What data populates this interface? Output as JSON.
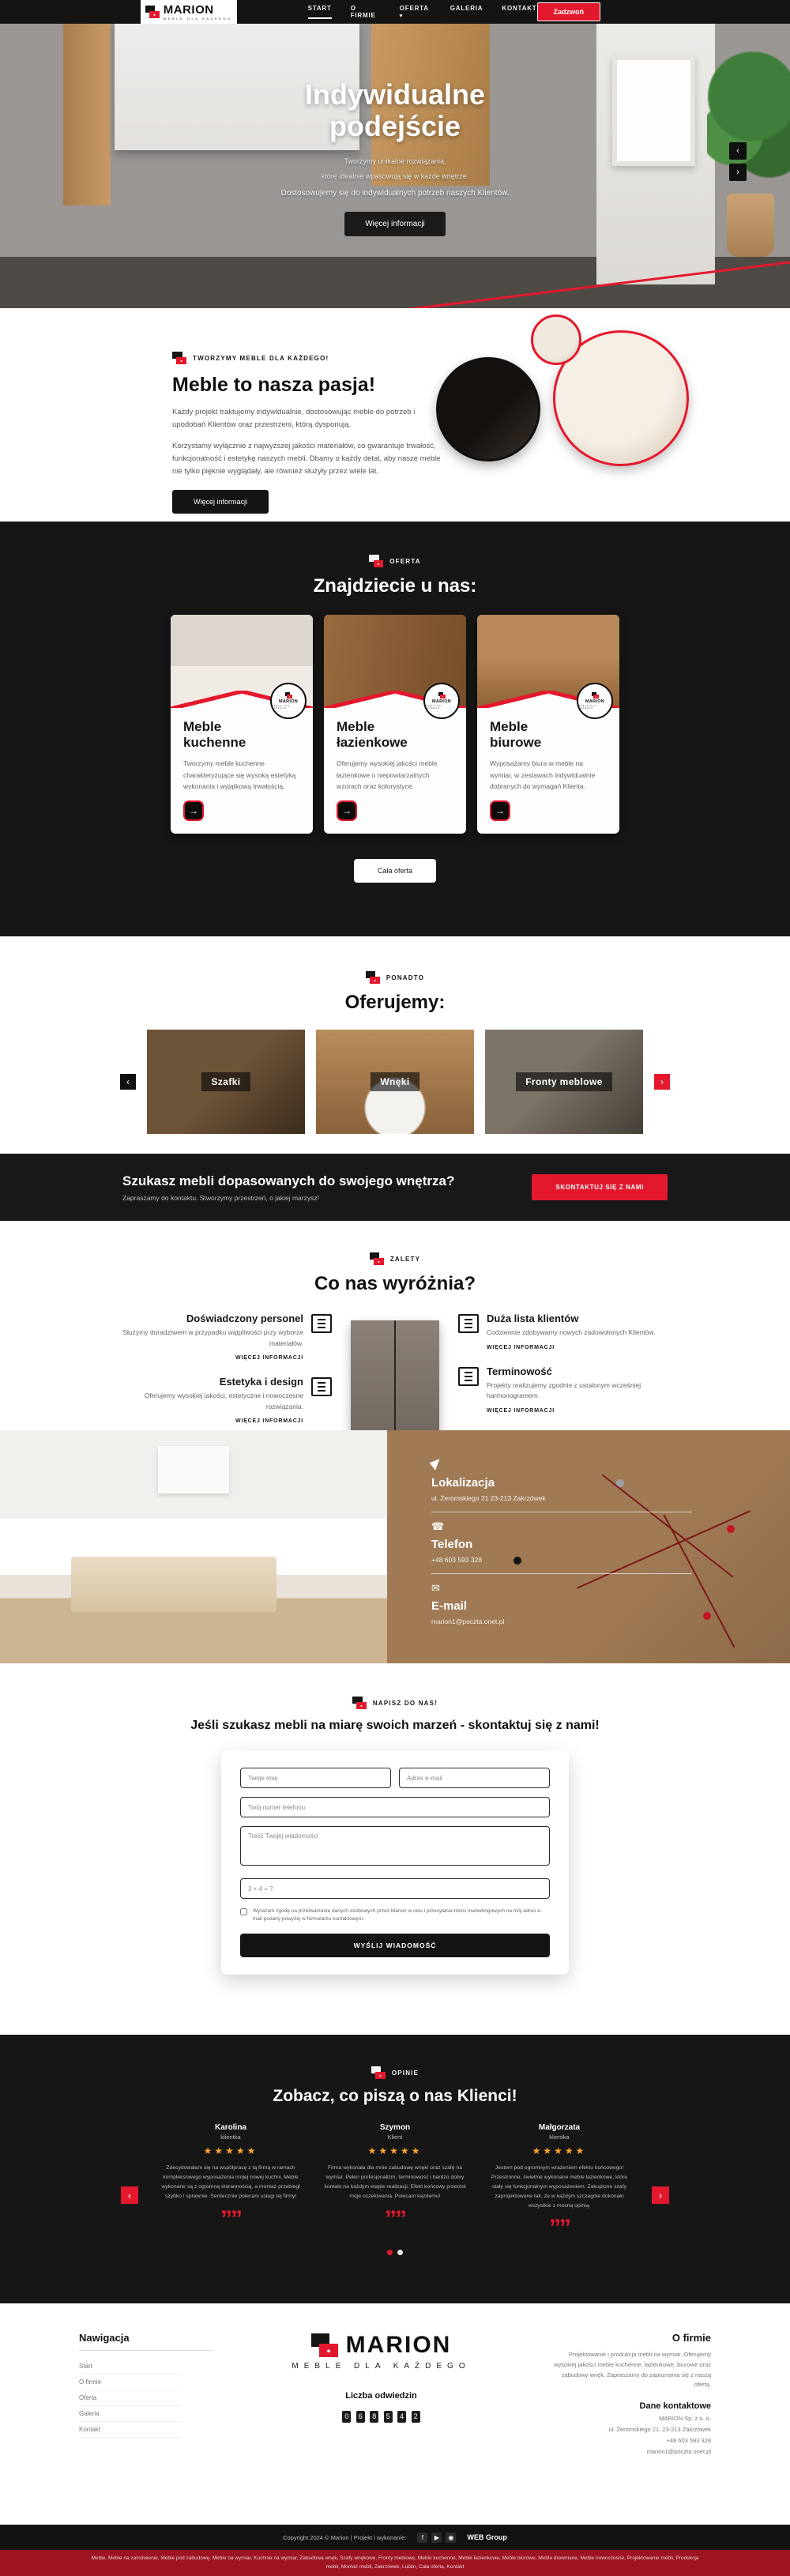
{
  "colors": {
    "accent": "#e4182d",
    "dark": "#161616",
    "star": "#ffa528",
    "cork": "#a07a55"
  },
  "header": {
    "logo_name": "MARION",
    "logo_tagline": "MEBLE DLA KAŻDEGO",
    "nav": [
      {
        "label": "START"
      },
      {
        "label": "O FIRMIE"
      },
      {
        "label": "OFERTA"
      },
      {
        "label": "GALERIA"
      },
      {
        "label": "KONTAKT"
      }
    ],
    "caret": "▾",
    "call_button": "Zadzwoń"
  },
  "hero": {
    "title_line1": "Indywidualne",
    "title_line2": "podejście",
    "subtitle_line1": "Tworzymy unikalne rozwiązania,",
    "subtitle_line2": "które idealnie wpasowują się w każde wnętrze.",
    "subtitle_line3": "Dostosowujemy się do indywidualnych potrzeb naszych Klientów.",
    "button": "Więcej informacji",
    "arrow_up": "‹",
    "arrow_down": "›"
  },
  "about": {
    "eyebrow": "TWORZYMY MEBLE DLA KAŻDEGO!",
    "title": "Meble to nasza pasja!",
    "p1": "Każdy projekt traktujemy indywidualnie, dostosowując meble do potrzeb i upodobań Klientów oraz przestrzeni, którą dysponują.",
    "p2": "Korzystamy wyłącznie z najwyższej jakości materiałów, co gwarantuje trwałość, funkcjonalność i estetykę naszych mebli. Dbamy o każdy detal, aby nasze meble nie tylko pięknie wyglądały, ale również służyły przez wiele lat.",
    "button": "Więcej informacji"
  },
  "offer": {
    "eyebrow": "OFERTA",
    "title": "Znajdziecie u nas:",
    "badge_name": "MARION",
    "badge_tag": "MEBLE DLA KAŻDEGO",
    "arrow": "→",
    "cards": [
      {
        "title": "Meble kuchenne",
        "text": "Tworzymy meble kuchenne charakteryzujące się wysoką estetyką wykonania i wyjątkową trwałością."
      },
      {
        "title": "Meble łazienkowe",
        "text": "Oferujemy wysokiej jakości meble łazienkowe o niepowtarzalnych wzorach oraz kolorystyce."
      },
      {
        "title": "Meble biurowe",
        "text": "Wyposażamy biura w meble na wymiar, w zestawach indywidualnie dobranych do wymagań Klienta."
      }
    ],
    "button": "Cała oferta"
  },
  "more": {
    "eyebrow": "PONADTO",
    "title": "Oferujemy:",
    "prev": "‹",
    "next": "›",
    "slides": [
      {
        "label": "Szafki"
      },
      {
        "label": "Wnęki"
      },
      {
        "label": "Fronty meblowe"
      }
    ]
  },
  "cta_band": {
    "title": "Szukasz mebli dopasowanych do swojego wnętrza?",
    "subtitle": "Zapraszamy do kontaktu. Stworzymy przestrzeń, o jakiej marzysz!",
    "button": "SKONTAKTUJ SIĘ Z NAMI"
  },
  "features": {
    "eyebrow": "ZALETY",
    "title": "Co nas wyróżnia?",
    "link_label": "WIĘCEJ INFORMACJI",
    "left": [
      {
        "title": "Doświadczony personel",
        "text": "Służymy doradztwem w przypadku wątpliwości przy wyborze materiałów."
      },
      {
        "title": "Estetyka i design",
        "text": "Oferujemy wysokiej jakości, estetyczne i nowoczesne rozwiązania."
      }
    ],
    "right": [
      {
        "title": "Duża lista klientów",
        "text": "Codziennie zdobywamy nowych zadowolonych Klientów."
      },
      {
        "title": "Terminowość",
        "text": "Projekty realizujemy zgodnie z ustalonym wcześniej harmonogramem."
      }
    ]
  },
  "contact_panel": {
    "items": [
      {
        "title": "Lokalizacja",
        "value": "ul. Żeromskiego 21 23-213 Zakrzówek"
      },
      {
        "title": "Telefon",
        "value": "+48 603 593 328"
      },
      {
        "title": "E-mail",
        "value": "marion1@poczta.onet.pl"
      }
    ],
    "phone_glyph": "☎",
    "mail_glyph": "✉"
  },
  "contact_form": {
    "eyebrow": "NAPISZ DO NAS!",
    "title": "Jeśli szukasz mebli na miarę swoich marzeń - skontaktuj się z nami!",
    "fields": {
      "name": "Twoje imię",
      "email": "Adres e-mail",
      "phone": "Twój numer telefonu",
      "message": "Treść Twojej wiadomości",
      "captcha": "3 + 4 = ?"
    },
    "consent": "Wyrażam zgodę na przetwarzanie danych osobowych przez Marion w celu i przesyłania treści marketingowych na mój adres e-mail podany powyżej w formularzu kontaktowym.",
    "button": "WYŚLIJ WIADOMOŚĆ"
  },
  "testimonials": {
    "eyebrow": "OPINIE",
    "title": "Zobacz, co piszą o nas Klienci!",
    "prev": "‹",
    "next": "›",
    "quote_glyph": "””",
    "items": [
      {
        "name": "Karolina",
        "role": "klientka",
        "stars": "★★★★★",
        "text": "Zdecydowałam się na współpracę z tą firmą w ramach kompleksowego wyposażenia mojej nowej kuchni. Meble wykonane są z ogromną starannością, a montaż przebiegł szybko i sprawnie. Serdecznie polecam usługi tej firmy!"
      },
      {
        "name": "Szymon",
        "role": "Klient",
        "stars": "★★★★★",
        "text": "Firma wykonała dla mnie zabudowę wnęki oraz szafę na wymiar. Pełen profesjonalizm, terminowość i bardzo dobry kontakt na każdym etapie realizacji. Efekt końcowy przerósł moje oczekiwania. Polecam każdemu!"
      },
      {
        "name": "Małgorzata",
        "role": "klientka",
        "stars": "★★★★★",
        "text": "Jestem pod ogromnym wrażeniem efektu końcowego! Przestronne, świetnie wykonane meble łazienkowe, które stały się funkcjonalnym wyposażeniem. Zakupione szafy zaprojektowane tak, że w każdym szczególe dokonało wszystkie z mocną opinią."
      }
    ]
  },
  "footer": {
    "nav_title": "Nawigacja",
    "links": [
      {
        "label": "Start"
      },
      {
        "label": "O firmie"
      },
      {
        "label": "Oferta"
      },
      {
        "label": "Galeria"
      },
      {
        "label": "Kontakt"
      }
    ],
    "logo_name": "MARION",
    "logo_tagline": "MEBLE DLA KAŻDEGO",
    "visits_label": "Liczba odwiedzin",
    "visits_digits": [
      "0",
      "6",
      "8",
      "5",
      "4",
      "2"
    ],
    "about_title": "O firmie",
    "about_text": "Projektowanie i produkcja mebli na wymiar. Oferujemy wysokiej jakości meble kuchenne, łazienkowe, biurowe oraz zabudowy wnęk. Zapraszamy do zapoznania się z naszą ofertą.",
    "contact_title": "Dane kontaktowe",
    "contact_lines": [
      "MARION Sp. z o. o.",
      "ul. Żeromskiego 21, 23-213 Zakrzówek",
      "+48 603 593 328",
      "marion1@poczta.onet.pl"
    ]
  },
  "copyright": {
    "text": "Copyright 2024 © Marion | Projekt i wykonanie:",
    "facebook_glyph": "f",
    "youtube_glyph": "▶",
    "instagram_glyph": "◉",
    "agency": "WEB Group"
  },
  "seo_band": {
    "text": "Meble, Meble na zamówienie, Meble pod zabudowę, Meble na wymiar, Kuchnie na wymiar, Zabudowa wnęk, Szafy wnękowe, Fronty meblowe, Meble kuchenne, Meble łazienkowe, Meble biurowe, Meble drewniane, Meble nowoczesne, Projektowanie mebli, Produkcja mebli, Montaż mebli, Zakrzówek, Lublin, Cała oferta, Kontakt"
  }
}
